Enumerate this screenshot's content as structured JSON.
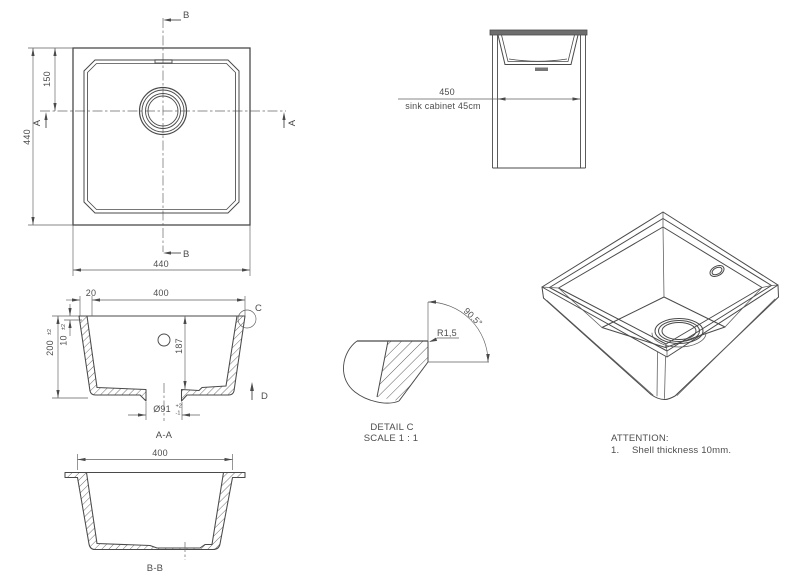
{
  "plan": {
    "dim_left": "440",
    "dim_bottom": "440",
    "dim_offset": "150",
    "marker_a": "A",
    "marker_b": "B"
  },
  "cabinet": {
    "dim": "450",
    "caption": "sink cabinet 45cm"
  },
  "section_aa": {
    "caption": "A-A",
    "dim_width": "400",
    "dim_rim_width": "20",
    "dim_height": "200",
    "dim_height_tol": "±2",
    "dim_rim_height": "10",
    "dim_rim_height_tol": "±2",
    "dim_depth": "187",
    "dim_drain": "Ø91",
    "drain_tol_plus": "+2",
    "drain_tol_minus": "-1",
    "marker_c": "C",
    "marker_d": "D"
  },
  "detail_c": {
    "title": "DETAIL C",
    "scale": "SCALE 1 : 1",
    "radius": "R1,5",
    "angle": "90.5°"
  },
  "section_bb": {
    "caption": "B-B",
    "dim_width": "400"
  },
  "attention": {
    "heading": "ATTENTION:",
    "item_number": "1.",
    "item_text": "Shell thickness 10mm."
  }
}
